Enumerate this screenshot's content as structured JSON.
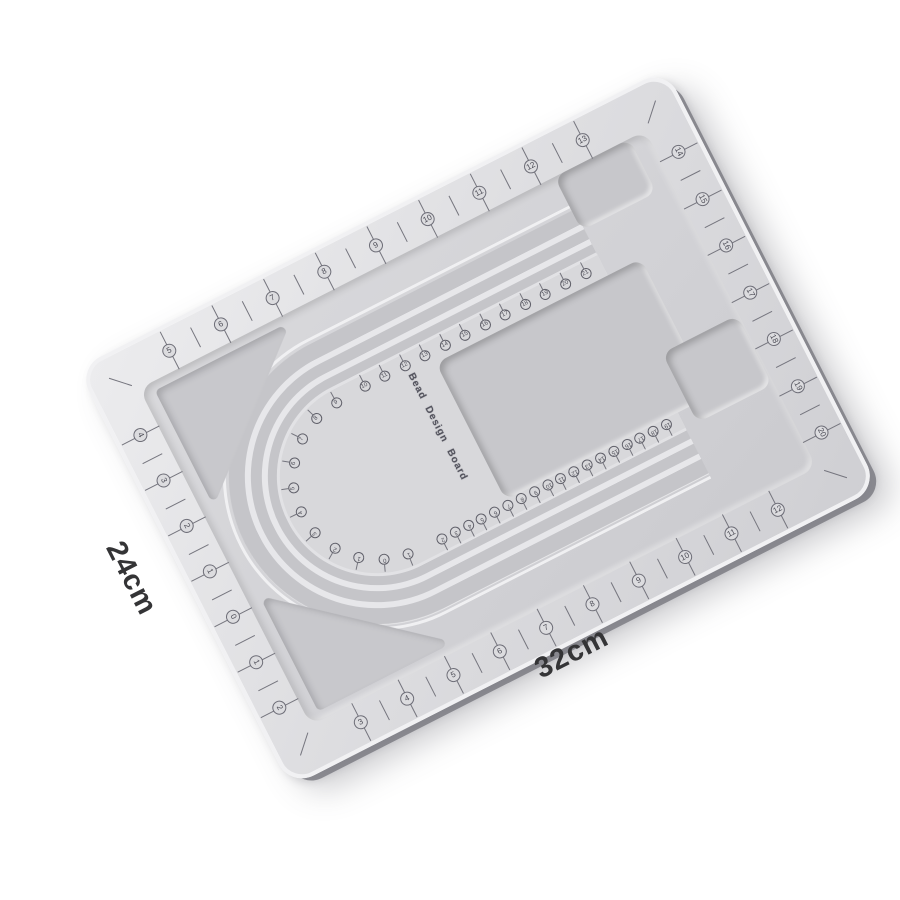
{
  "product": {
    "title_text": "Bead Design Board",
    "dim_side_label": "24cm",
    "dim_bottom_label": "32cm"
  },
  "colors": {
    "background": "#ffffff",
    "board_surface": "#dedee1",
    "floor": "#d1d1d5",
    "groove": "#c5c5c9",
    "groove_divider": "#e7e7ea",
    "recess": "#c7c7cb",
    "marking": "#4b4b55",
    "edge_highlight": "#f1f1f3",
    "edge_shadow": "#7d7d84"
  },
  "rim_scale": {
    "top_left_to_right": [
      "5",
      "6",
      "7",
      "8",
      "9",
      "10",
      "11",
      "12",
      "13"
    ],
    "bottom_left_to_right": [
      "3",
      "4",
      "5",
      "6",
      "7",
      "8",
      "9",
      "10",
      "11",
      "12"
    ],
    "left_top_to_bottom": [
      "4",
      "3",
      "2",
      "1",
      "0",
      "1",
      "2"
    ],
    "right_top_to_bottom": [
      "14",
      "15",
      "16",
      "17",
      "18",
      "19",
      "20"
    ]
  },
  "channel_scale": {
    "arc_upper": [
      "0",
      "1",
      "2",
      "3",
      "4",
      "5",
      "6",
      "7",
      "8",
      "9"
    ],
    "arc_lower": [
      "1"
    ],
    "top_row": [
      "10",
      "11",
      "12",
      "13",
      "14",
      "15",
      "16",
      "17",
      "18",
      "19",
      "20",
      "21"
    ],
    "bottom_row": [
      "2",
      "3",
      "4",
      "5",
      "6",
      "7",
      "8",
      "9",
      "10",
      "11",
      "12",
      "13",
      "14",
      "15",
      "16",
      "17",
      "18",
      "19"
    ]
  }
}
